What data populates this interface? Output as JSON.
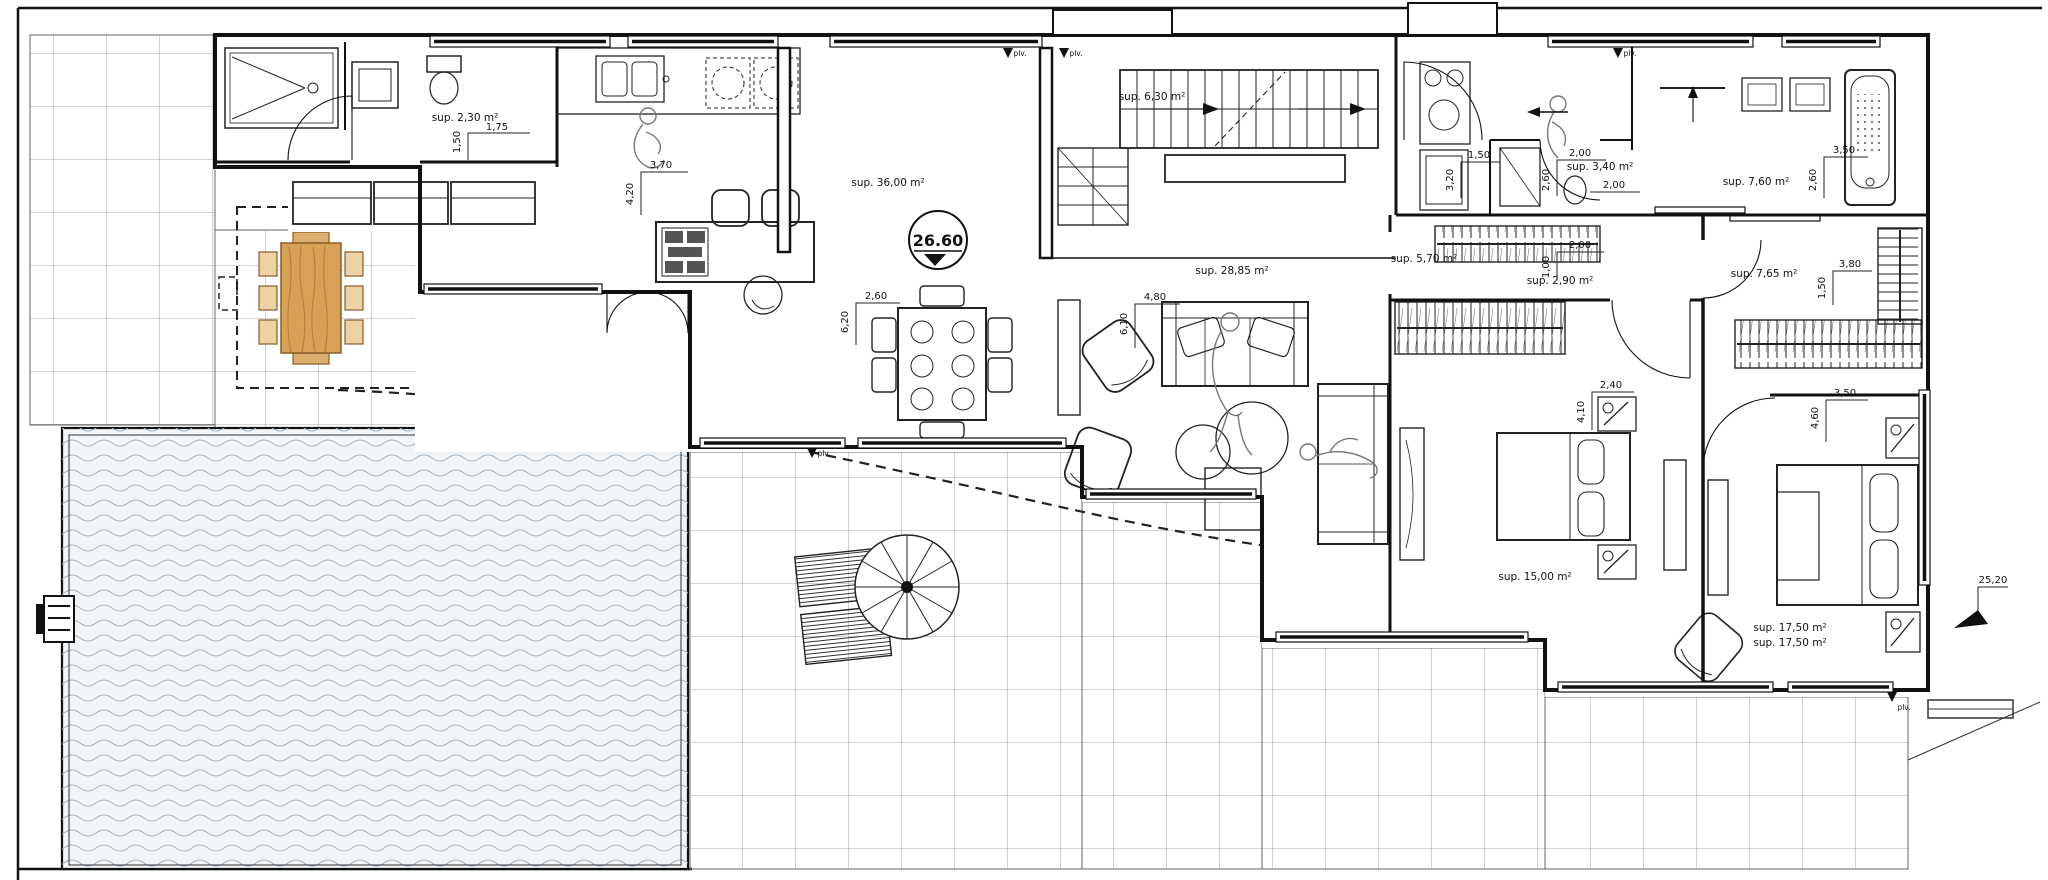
{
  "drawing": {
    "type": "architectural floor plan - villa ground floor",
    "level_marker": "26.60",
    "plv_label": "plv.",
    "rooms": {
      "wc": "sup. 2,30 m²",
      "kitchen_living": "sup. 36,00 m²",
      "stairs": "sup. 6,30 m²",
      "lounge": "sup. 28,85 m²",
      "hall": "sup. 5,70 m²",
      "lobby": "sup. 2,90 m²",
      "bath_small": "sup. 3,40 m²",
      "bath_main": "sup. 7,60 m²",
      "dressing": "sup. 7,65 m²",
      "bedroom_1": "sup. 15,00 m²",
      "bedroom_2_line1": "sup. 17,50 m²",
      "bedroom_2_line2": "sup. 17,50 m²"
    },
    "dimensions": {
      "wc_w": "1,75",
      "wc_h": "1,50",
      "kitchen_w": "3,70",
      "kitchen_h": "4,20",
      "dining_w": "2,60",
      "dining_h": "6,20",
      "lounge_w": "4,80",
      "lounge_h": "6,10",
      "laundry_w": "1,50",
      "laundry_h": "3,20",
      "bath_small_w": "2,00",
      "bath_small_h": "2,60",
      "hall_w": "2,00",
      "lobby_w": "2,00",
      "lobby_h": "1,00",
      "bath_main_w": "3,50",
      "bath_main_h": "2,60",
      "dressing_w": "3,80",
      "dressing_h": "1,50",
      "bedroom_1_w": "2,40",
      "bedroom_1_h": "4,10",
      "bedroom_2_w": "3,50",
      "bedroom_2_h": "4,60",
      "site_level": "25,20"
    }
  }
}
